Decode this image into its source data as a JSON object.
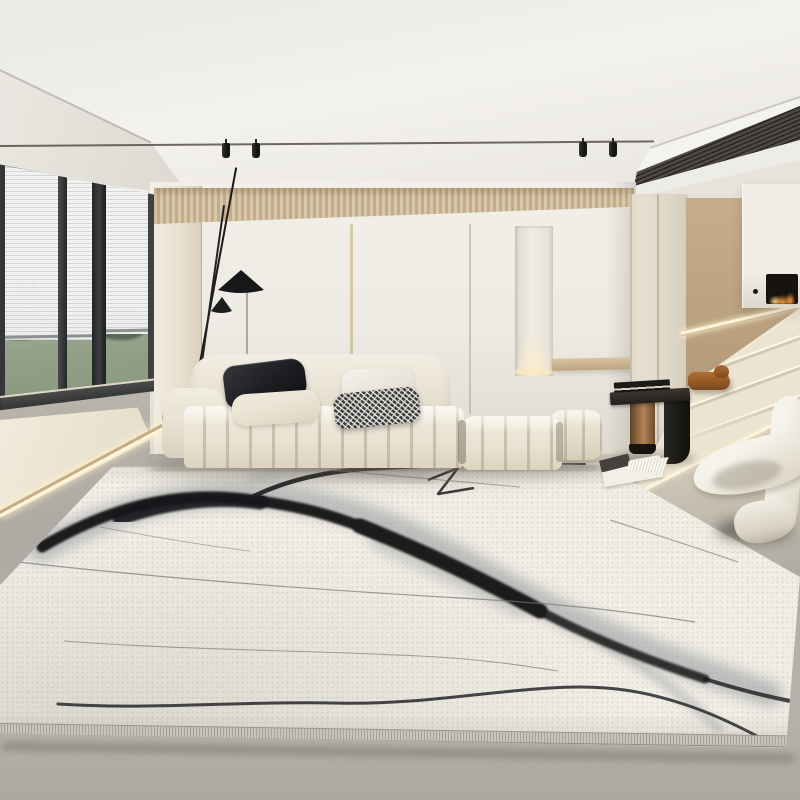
{
  "meta": {
    "title": "Minimalist living room with cream modular sofa and abstract ink-wash area rug",
    "image_type": "interior product photograph",
    "no_visible_text": true
  },
  "objects": [
    "ceiling",
    "ceiling-track-light",
    "track-spotlights",
    "linear-air-vent",
    "corner-window",
    "venetian-blinds",
    "lawn-view",
    "city-skyline",
    "trees",
    "window-platform",
    "led-edge-strip",
    "fluted-wood-wall-panel",
    "back-wall",
    "wall-niche-light",
    "wall-console-ledge",
    "black-floor-lamp",
    "lamp-cone-shades",
    "cream-modular-sofa",
    "black-leather-pillow",
    "cream-pillow",
    "white-pillow",
    "houndstooth-pillow",
    "gray-cube-side-table",
    "ink-wash-area-rug",
    "rug-serged-border",
    "wood-and-black-side-table",
    "stacked-book",
    "open-magazine",
    "white-sculptural-lounge-chair",
    "staircase",
    "handrail-light",
    "stair-base-light",
    "closet-doors",
    "tan-accent-wall",
    "floating-fireplace",
    "fireplace-flames",
    "dog-sculpture",
    "concrete-floor"
  ],
  "palette": {
    "ceiling": "#edebe6",
    "ceiling_bright": "#f4f2ee",
    "soffit": "#dcd8d1",
    "hall_ceiling": "#e7e3db",
    "vent": "#433f39",
    "track": "#4b463e",
    "spotlight": "#151514",
    "fluted_light": "#d9c7a9",
    "fluted_dark": "#c2ac8a",
    "wall": "#f1eee8",
    "wall_shade": "#e2ddd3",
    "pilaster": "#e8e1d1",
    "window_frame": "#393b3b",
    "blind_light": "#f0f1f0",
    "blind_dark": "#d5d5d4",
    "sky": "#e9ebe9",
    "lawn": "#94a189",
    "tree": "#4e5c4e",
    "platform": "#f3ecdd",
    "gold_trim": "#c3ae83",
    "led": "#fff4da",
    "floor_light": "#dcd6c9",
    "floor_dark": "#aca8a2",
    "hall_floor": "#e0d8c7",
    "rug": "#f1eee5",
    "serge": "#c9c5bb",
    "ink": "#1b1c1e",
    "ink_wash": "#a9abad",
    "hairline": "#73757a",
    "sofa": "#f0ebe0",
    "sofa_shade": "#dcd3c0",
    "pillow_black": "#1d1e21",
    "pillow_cream": "#ebe5d6",
    "pillow_white": "#f5f2ec",
    "houndstooth_dark": "#3b3c3e",
    "houndstooth_light": "#e9e7e1",
    "tan_wall": "#c5ad8e",
    "closet": "#eae3d4",
    "stair": "#ece4d2",
    "stair_nose": "#fff7e3",
    "stair_shade": "#d3c9b2",
    "fireplace_box": "#f2eee7",
    "fire_opening": "#171310",
    "flame": "#ff9e3c",
    "flame_bright": "#ffd37e",
    "wood": "#9c7348",
    "wood_dark": "#5f4326",
    "table_black": "#201e1b",
    "chair": "#f6f3ec",
    "chair_shade": "#d8d2c4",
    "dog": "#b06e33",
    "dog_dark": "#7c481d"
  }
}
